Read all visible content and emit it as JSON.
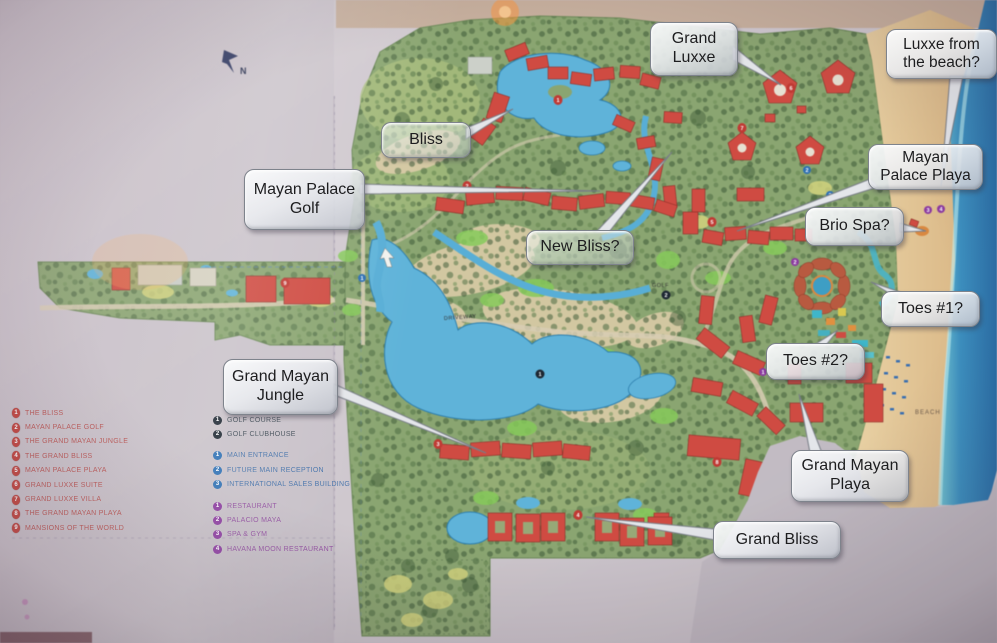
{
  "map": {
    "compass_label": "N",
    "labels": {
      "golf": "GOLF",
      "driveway": "DRIVEWAY",
      "beach": "BEACH"
    }
  },
  "legend": {
    "resorts": [
      {
        "num": "1",
        "label": "THE BLISS"
      },
      {
        "num": "2",
        "label": "MAYAN PALACE GOLF"
      },
      {
        "num": "3",
        "label": "THE GRAND MAYAN JUNGLE"
      },
      {
        "num": "4",
        "label": "THE GRAND BLISS"
      },
      {
        "num": "5",
        "label": "MAYAN PALACE PLAYA"
      },
      {
        "num": "6",
        "label": "GRAND LUXXE SUITE"
      },
      {
        "num": "7",
        "label": "GRAND LUXXE VILLA"
      },
      {
        "num": "8",
        "label": "THE GRAND MAYAN PLAYA"
      },
      {
        "num": "9",
        "label": "MANSIONS OF THE WORLD"
      }
    ],
    "golf": [
      {
        "num": "1",
        "label": "GOLF COURSE"
      },
      {
        "num": "2",
        "label": "GOLF CLUBHOUSE"
      }
    ],
    "facilities": [
      {
        "num": "1",
        "label": "MAIN ENTRANCE"
      },
      {
        "num": "2",
        "label": "FUTURE MAIN RECEPTION"
      },
      {
        "num": "3",
        "label": "INTERNATIONAL SALES BUILDING"
      }
    ],
    "amenities": [
      {
        "num": "1",
        "label": "RESTAURANT"
      },
      {
        "num": "2",
        "label": "PALACIO MAYA"
      },
      {
        "num": "3",
        "label": "SPA & GYM"
      },
      {
        "num": "4",
        "label": "HAVANA MOON RESTAURANT"
      }
    ]
  },
  "callouts": [
    {
      "id": "grand-luxxe",
      "line1": "Grand",
      "line2": "Luxxe"
    },
    {
      "id": "luxxe-from-the-beach",
      "line1": "Luxxe from",
      "line2": "the beach?"
    },
    {
      "id": "bliss",
      "line1": "Bliss",
      "line2": ""
    },
    {
      "id": "mayan-palace-golf",
      "line1": "Mayan Palace",
      "line2": "Golf"
    },
    {
      "id": "new-bliss",
      "line1": "New Bliss?",
      "line2": ""
    },
    {
      "id": "mayan-palace-playa",
      "line1": "Mayan",
      "line2": "Palace Playa"
    },
    {
      "id": "brio-spa",
      "line1": "Brio Spa?",
      "line2": ""
    },
    {
      "id": "toes-1",
      "line1": "Toes #1?",
      "line2": ""
    },
    {
      "id": "toes-2",
      "line1": "Toes #2?",
      "line2": ""
    },
    {
      "id": "grand-mayan-jungle",
      "line1": "Grand Mayan",
      "line2": "Jungle"
    },
    {
      "id": "grand-mayan-playa",
      "line1": "Grand Mayan",
      "line2": "Playa"
    },
    {
      "id": "grand-bliss",
      "line1": "Grand Bliss",
      "line2": ""
    }
  ],
  "markers": {
    "resort": [
      {
        "num": "1"
      },
      {
        "num": "2"
      },
      {
        "num": "3"
      },
      {
        "num": "4"
      },
      {
        "num": "5"
      },
      {
        "num": "6"
      },
      {
        "num": "7"
      },
      {
        "num": "8"
      },
      {
        "num": "9"
      }
    ],
    "golf": [
      {
        "num": "1"
      },
      {
        "num": "2"
      }
    ],
    "facilities": [
      {
        "num": "1"
      },
      {
        "num": "2"
      },
      {
        "num": "3"
      }
    ],
    "amenities": [
      {
        "num": "1"
      },
      {
        "num": "2"
      },
      {
        "num": "3"
      },
      {
        "num": "4"
      }
    ]
  },
  "colors": {
    "wall": "#c9c2ca",
    "vegetation": "#8aa571",
    "lake": "#5fb3d9",
    "ocean": "#2a76ad",
    "beach": "#e3c18f",
    "building": "#cf4b42",
    "callout_border": "#7e838c"
  }
}
